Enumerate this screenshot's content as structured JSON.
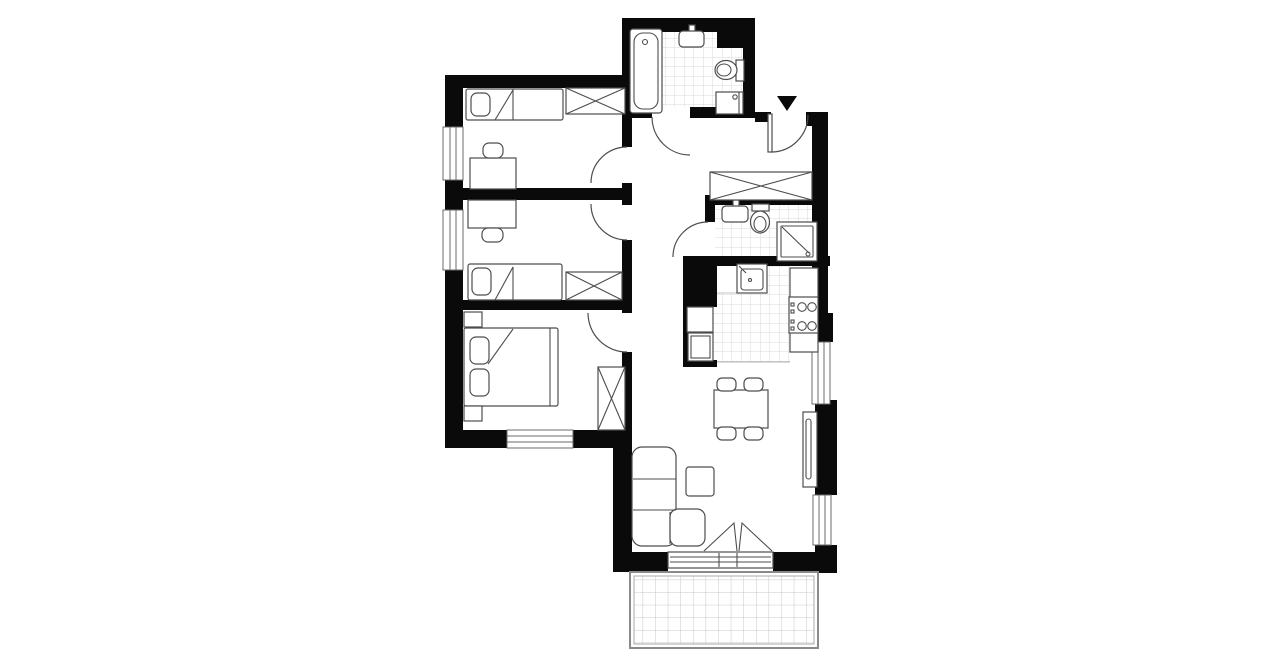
{
  "title": "apartment-floor-plan",
  "palette": {
    "wall": "#0a0a0a",
    "furniture_line": "#4d4d4d",
    "tile_line": "#dadada",
    "balcony_grid": "#c8c8c8",
    "background": "#ffffff"
  },
  "entrance": {
    "marker": "black-triangle-pointing-down",
    "door_swing": "inward-right"
  },
  "rooms": [
    {
      "name": "bedroom-1",
      "position": "top-left",
      "furniture": [
        "single-bed",
        "pillow",
        "wardrobe-crossed",
        "desk",
        "chair",
        "left-wall-window",
        "door"
      ]
    },
    {
      "name": "bedroom-2",
      "position": "middle-left",
      "furniture": [
        "desk",
        "chair",
        "single-bed",
        "pillow",
        "wardrobe-crossed",
        "left-wall-window",
        "door"
      ]
    },
    {
      "name": "bedroom-3",
      "position": "bottom-left",
      "furniture": [
        "double-bed",
        "pillow",
        "pillow",
        "nightstand",
        "nightstand",
        "wardrobe-crossed",
        "bottom-wall-window",
        "door"
      ]
    },
    {
      "name": "bathroom-1",
      "position": "top",
      "furniture": [
        "bathtub",
        "washbasin",
        "toilet",
        "washing-machine",
        "tiled-floor",
        "door"
      ]
    },
    {
      "name": "bathroom-2",
      "position": "middle-right",
      "furniture": [
        "washbasin",
        "toilet",
        "shower-cabin",
        "tiled-floor",
        "door"
      ]
    },
    {
      "name": "kitchen",
      "position": "right",
      "furniture": [
        "kitchen-sink",
        "countertop",
        "cooktop-4-burners",
        "tall-cabinet",
        "fridge",
        "tiled-floor"
      ]
    },
    {
      "name": "hallway",
      "position": "center",
      "furniture": [
        "wardrobe-crossed",
        "entrance-door"
      ]
    },
    {
      "name": "living-dining-room",
      "position": "bottom-right",
      "furniture": [
        "dining-table",
        "chair",
        "chair",
        "chair",
        "chair",
        "corner-sofa",
        "coffee-table",
        "radiator",
        "balcony-fold-door",
        "right-wall-window",
        "right-wall-window"
      ]
    },
    {
      "name": "balcony",
      "position": "bottom",
      "furniture": [
        "tiled-deck"
      ]
    }
  ]
}
